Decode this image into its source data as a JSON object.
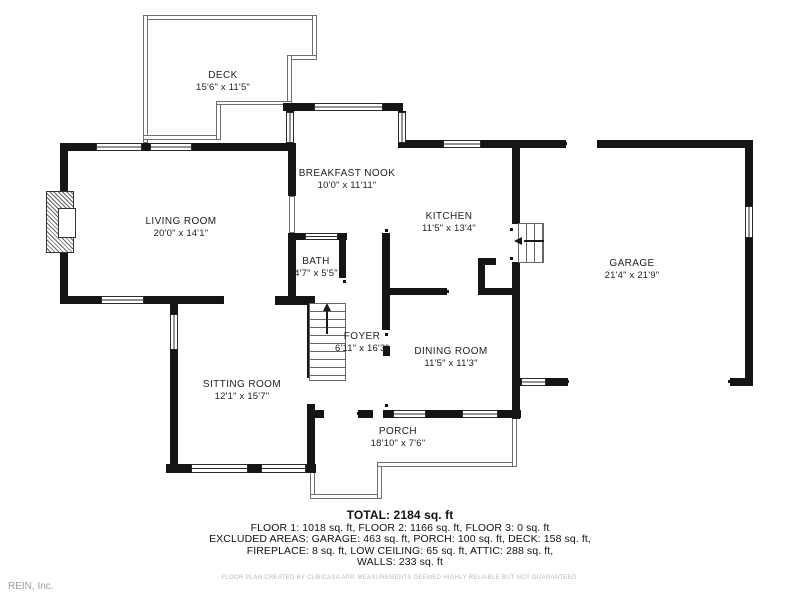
{
  "plan": {
    "rooms": [
      {
        "id": "deck",
        "name": "DECK",
        "dims": "15'6\" x 11'5\""
      },
      {
        "id": "living-room",
        "name": "LIVING ROOM",
        "dims": "20'0\" x 14'1\""
      },
      {
        "id": "breakfast-nook",
        "name": "BREAKFAST NOOK",
        "dims": "10'0\" x 11'11\""
      },
      {
        "id": "kitchen",
        "name": "KITCHEN",
        "dims": "11'5\" x 13'4\""
      },
      {
        "id": "bath",
        "name": "BATH",
        "dims": "4'7\" x 5'5\""
      },
      {
        "id": "garage",
        "name": "GARAGE",
        "dims": "21'4\" x 21'9\""
      },
      {
        "id": "foyer",
        "name": "FOYER",
        "dims": "6'11\" x 16'3\""
      },
      {
        "id": "sitting-room",
        "name": "SITTING ROOM",
        "dims": "12'1\" x 15'7\""
      },
      {
        "id": "dining-room",
        "name": "DINING ROOM",
        "dims": "11'5\" x 11'3\""
      },
      {
        "id": "porch",
        "name": "PORCH",
        "dims": "18'10\" x 7'6\""
      }
    ],
    "summary": {
      "total": "TOTAL: 2184 sq. ft",
      "floors": "FLOOR 1: 1018 sq. ft, FLOOR 2: 1166 sq. ft, FLOOR 3: 0 sq. ft",
      "excluded_line1": "EXCLUDED AREAS: GARAGE: 463 sq. ft, PORCH: 100 sq. ft, DECK: 158 sq. ft,",
      "excluded_line2": "FIREPLACE: 8 sq. ft, LOW CEILING: 65 sq. ft, ATTIC: 288 sq. ft,",
      "excluded_line3": "WALLS: 233 sq. ft",
      "disclaimer": "FLOOR PLAN CREATED BY CUBICASA APP. MEASUREMENTS DEEMED HIGHLY RELIABLE BUT NOT GUARANTEED."
    },
    "branding": {
      "watermark": "REIN, Inc."
    }
  }
}
